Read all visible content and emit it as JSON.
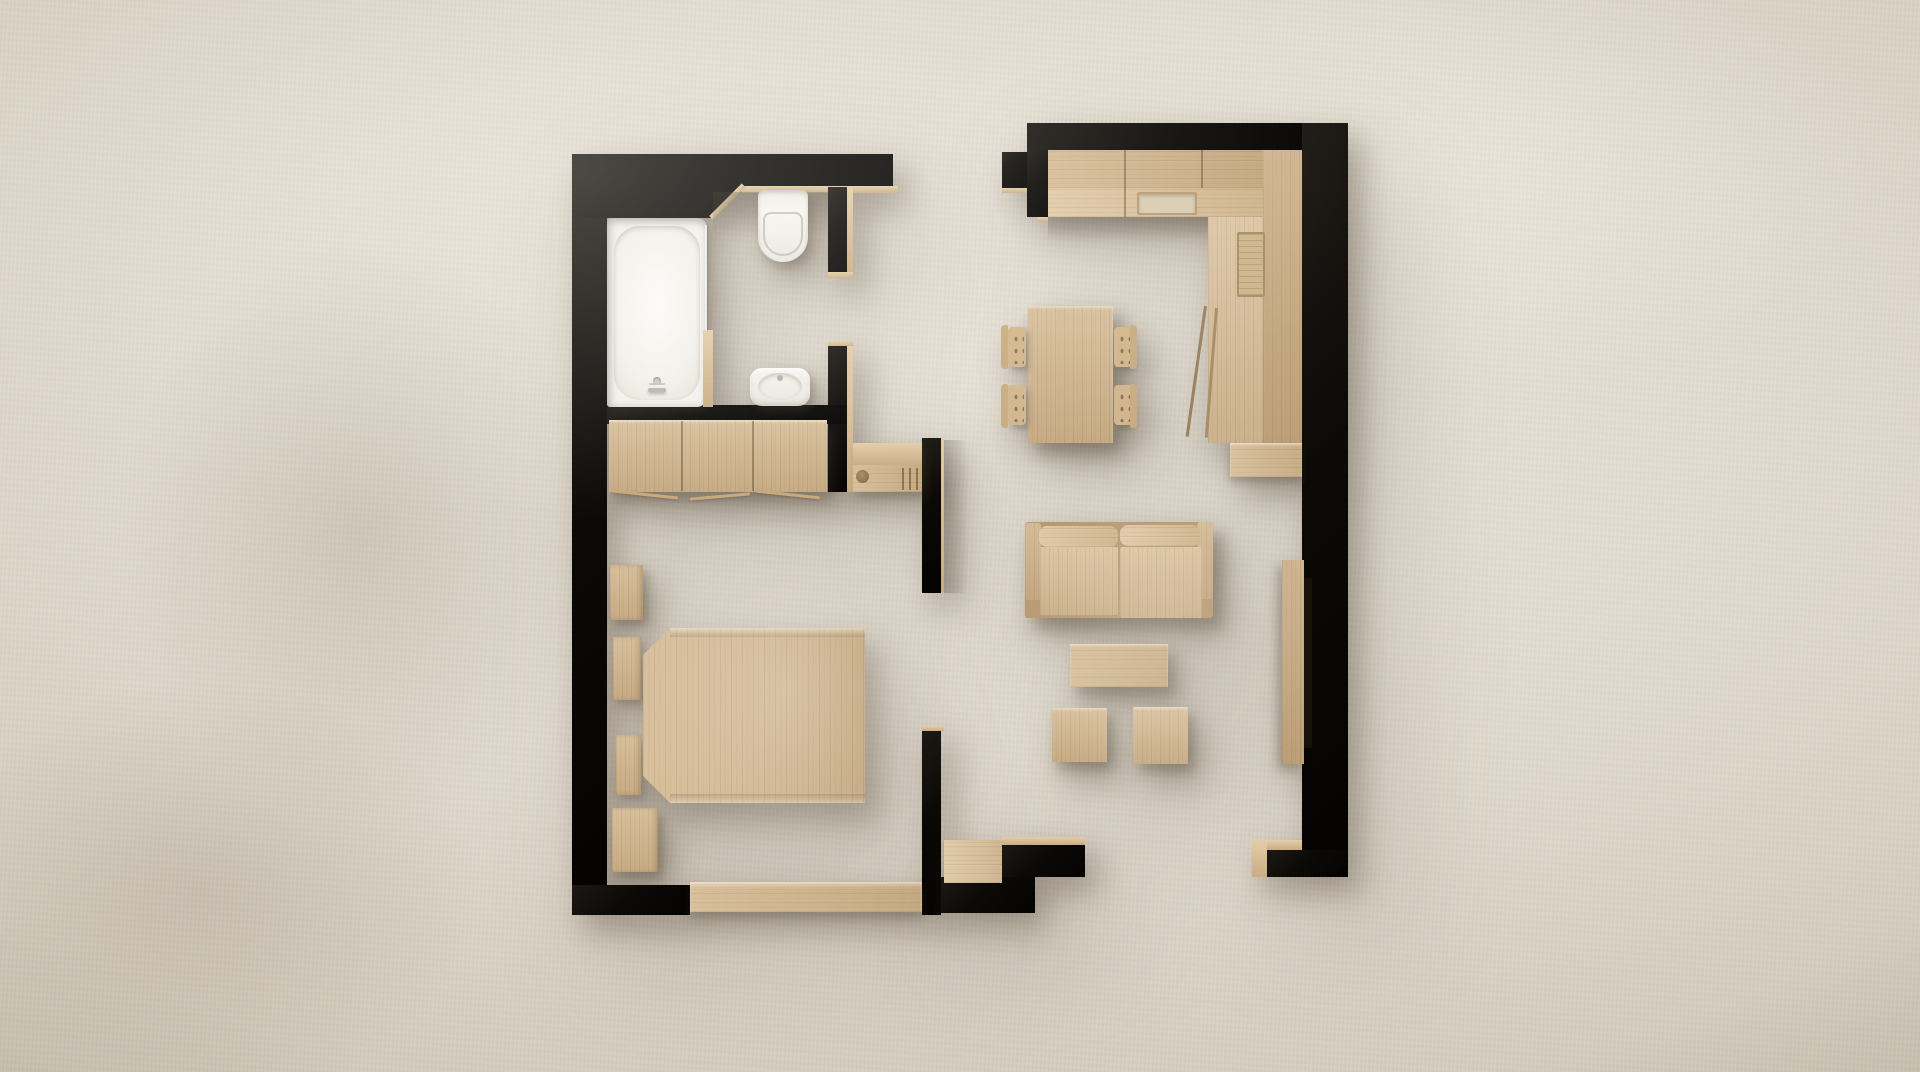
{
  "scene": {
    "description": "Minimalist top-down 3D floor plan render of a one-bedroom apartment on a beige plaster background",
    "view": "top-down floor plan",
    "text_visible": "none"
  },
  "palette": {
    "background": "#ddd6c9",
    "background_light": "#eae4da",
    "wall": "#0c0a07",
    "wood": "#d2b68d",
    "wood_dark": "#c3a47a",
    "wood_light": "#e3cda9",
    "porcelain": "#f3f1ed",
    "tv": "#171108",
    "shadow": "rgba(72,59,43,0.38)"
  },
  "rooms": {
    "bathroom": "Bathroom",
    "bedroom": "Bedroom",
    "hall": "Entry hall",
    "living_kitchen": "Living room / kitchen"
  },
  "items": {
    "bathtub": "Bathtub",
    "toilet": "Toilet",
    "sink": "Washbasin",
    "wardrobe": "Wardrobe with sliding doors",
    "nightstand": "Nightstand",
    "bed": "Double bed",
    "bench": "Window bench",
    "entry_console": "Entry console with slatted shoe rack",
    "kitchen_counter": "L-shaped kitchen counter",
    "kitchen_sink": "Kitchen sink",
    "oven": "Built-in appliance",
    "open_cabinet_door": "Open cabinet door",
    "dining_table": "Dining table",
    "dining_chair": "Dining chair",
    "sofa": "Two-seat sofa",
    "coffee_table": "Coffee table",
    "stool": "Side stool",
    "tv_console": "TV console",
    "tv": "Television"
  }
}
